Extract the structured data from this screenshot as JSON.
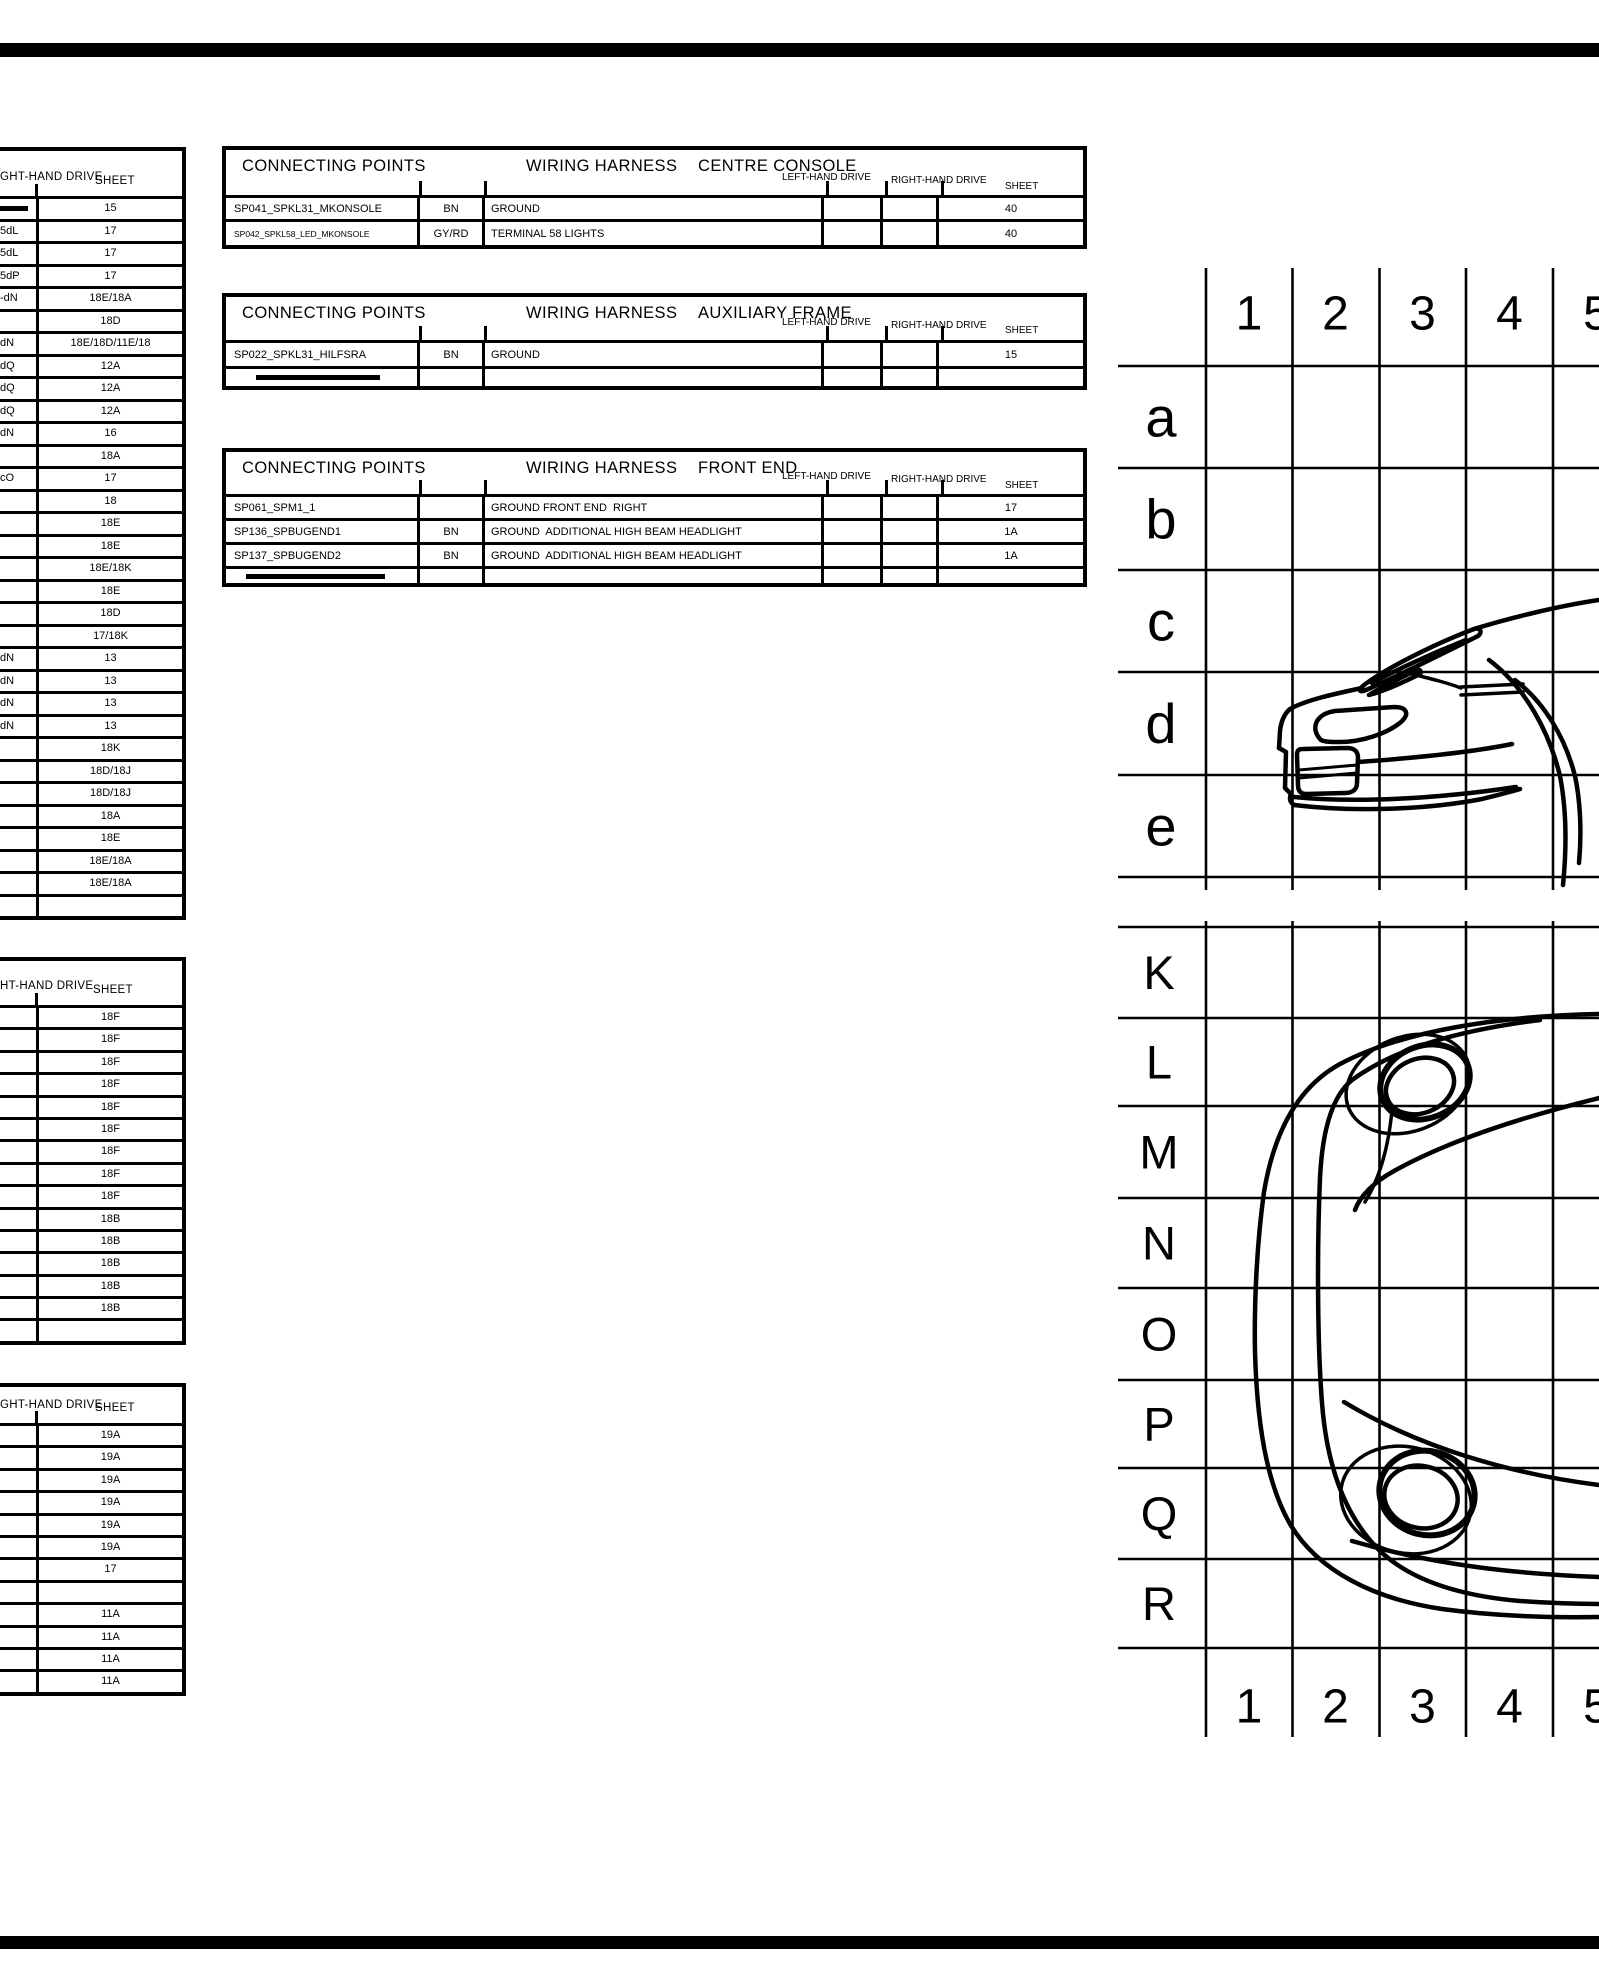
{
  "connecting_tables": [
    {
      "title": "CONNECTING POINTS",
      "harness_label": "WIRING HARNESS",
      "area": "CENTRE CONSOLE",
      "lhd_label": "LEFT-HAND DRIVE",
      "rhd_label": "RIGHT-HAND DRIVE",
      "sheet_label": "SHEET",
      "rows": [
        {
          "name": "SP041_SPKL31_MKONSOLE",
          "color": "BN",
          "desc": "GROUND",
          "lhd": "",
          "rhd": "",
          "sheet": "40",
          "small": false
        },
        {
          "name": "SP042_SPKL58_LED_MKONSOLE",
          "color": "GY/RD",
          "desc": "TERMINAL 58 LIGHTS",
          "lhd": "",
          "rhd": "",
          "sheet": "40",
          "small": true
        }
      ],
      "redacted_row": false
    },
    {
      "title": "CONNECTING POINTS",
      "harness_label": "WIRING HARNESS",
      "area": "AUXILIARY FRAME",
      "lhd_label": "LEFT-HAND DRIVE",
      "rhd_label": "RIGHT-HAND DRIVE",
      "sheet_label": "SHEET",
      "rows": [
        {
          "name": "SP022_SPKL31_HILFSRA",
          "color": "BN",
          "desc": "GROUND",
          "lhd": "",
          "rhd": "",
          "sheet": "15",
          "small": false
        }
      ],
      "redacted_row": true
    },
    {
      "title": "CONNECTING POINTS",
      "harness_label": "WIRING HARNESS",
      "area": "FRONT END",
      "lhd_label": "LEFT-HAND DRIVE",
      "rhd_label": "RIGHT-HAND DRIVE",
      "sheet_label": "SHEET",
      "rows": [
        {
          "name": "SP061_SPM1_1",
          "color": "",
          "desc": "GROUND FRONT END  RIGHT",
          "lhd": "",
          "rhd": "",
          "sheet": "17",
          "small": false
        },
        {
          "name": "SP136_SPBUGEND1",
          "color": "BN",
          "desc": "GROUND  ADDITIONAL HIGH BEAM HEADLIGHT",
          "lhd": "",
          "rhd": "",
          "sheet": "1A",
          "small": false
        },
        {
          "name": "SP137_SPBUGEND2",
          "color": "BN",
          "desc": "GROUND  ADDITIONAL HIGH BEAM HEADLIGHT",
          "lhd": "",
          "rhd": "",
          "sheet": "1A",
          "small": false
        }
      ],
      "redacted_row": true
    }
  ],
  "left_tables": [
    {
      "drive_label": "GHT-HAND DRIVE",
      "sheet_label": "SHEET",
      "rows": [
        {
          "frag": "",
          "sheet": "15",
          "redacted": true
        },
        {
          "frag": "5dL",
          "sheet": "17",
          "redacted": false
        },
        {
          "frag": "5dL",
          "sheet": "17",
          "redacted": false
        },
        {
          "frag": "5dP",
          "sheet": "17",
          "redacted": false
        },
        {
          "frag": "-dN",
          "sheet": "18E/18A",
          "redacted": false
        },
        {
          "frag": "",
          "sheet": "18D",
          "redacted": false
        },
        {
          "frag": "dN",
          "sheet": "18E/18D/11E/18",
          "redacted": false
        },
        {
          "frag": "dQ",
          "sheet": "12A",
          "redacted": false
        },
        {
          "frag": "dQ",
          "sheet": "12A",
          "redacted": false
        },
        {
          "frag": "dQ",
          "sheet": "12A",
          "redacted": false
        },
        {
          "frag": "dN",
          "sheet": "16",
          "redacted": false
        },
        {
          "frag": "",
          "sheet": "18A",
          "redacted": false
        },
        {
          "frag": "cO",
          "sheet": "17",
          "redacted": false
        },
        {
          "frag": "",
          "sheet": "18",
          "redacted": false
        },
        {
          "frag": "",
          "sheet": "18E",
          "redacted": false
        },
        {
          "frag": "",
          "sheet": "18E",
          "redacted": false
        },
        {
          "frag": "",
          "sheet": "18E/18K",
          "redacted": false
        },
        {
          "frag": "",
          "sheet": "18E",
          "redacted": false
        },
        {
          "frag": "",
          "sheet": "18D",
          "redacted": false
        },
        {
          "frag": "",
          "sheet": "17/18K",
          "redacted": false
        },
        {
          "frag": "dN",
          "sheet": "13",
          "redacted": false
        },
        {
          "frag": "dN",
          "sheet": "13",
          "redacted": false
        },
        {
          "frag": "dN",
          "sheet": "13",
          "redacted": false
        },
        {
          "frag": "dN",
          "sheet": "13",
          "redacted": false
        },
        {
          "frag": "",
          "sheet": "18K",
          "redacted": false
        },
        {
          "frag": "",
          "sheet": "18D/18J",
          "redacted": false
        },
        {
          "frag": "",
          "sheet": "18D/18J",
          "redacted": false
        },
        {
          "frag": "",
          "sheet": "18A",
          "redacted": false
        },
        {
          "frag": "",
          "sheet": "18E",
          "redacted": false
        },
        {
          "frag": "",
          "sheet": "18E/18A",
          "redacted": false
        },
        {
          "frag": "",
          "sheet": "18E/18A",
          "redacted": false
        },
        {
          "frag": "",
          "sheet": "",
          "redacted": false
        }
      ]
    },
    {
      "drive_label": "HT-HAND DRIVE",
      "sheet_label": "SHEET",
      "rows": [
        {
          "frag": "",
          "sheet": "18F",
          "redacted": false
        },
        {
          "frag": "",
          "sheet": "18F",
          "redacted": false
        },
        {
          "frag": "",
          "sheet": "18F",
          "redacted": false
        },
        {
          "frag": "",
          "sheet": "18F",
          "redacted": false
        },
        {
          "frag": "",
          "sheet": "18F",
          "redacted": false
        },
        {
          "frag": "",
          "sheet": "18F",
          "redacted": false
        },
        {
          "frag": "",
          "sheet": "18F",
          "redacted": false
        },
        {
          "frag": "",
          "sheet": "18F",
          "redacted": false
        },
        {
          "frag": "",
          "sheet": "18F",
          "redacted": false
        },
        {
          "frag": "",
          "sheet": "18B",
          "redacted": false
        },
        {
          "frag": "",
          "sheet": "18B",
          "redacted": false
        },
        {
          "frag": "",
          "sheet": "18B",
          "redacted": false
        },
        {
          "frag": "",
          "sheet": "18B",
          "redacted": false
        },
        {
          "frag": "",
          "sheet": "18B",
          "redacted": false
        },
        {
          "frag": "",
          "sheet": "",
          "redacted": false
        }
      ]
    },
    {
      "drive_label": "GHT-HAND DRIVE",
      "sheet_label": "SHEET",
      "rows": [
        {
          "frag": "",
          "sheet": "19A",
          "redacted": false
        },
        {
          "frag": "",
          "sheet": "19A",
          "redacted": false
        },
        {
          "frag": "",
          "sheet": "19A",
          "redacted": false
        },
        {
          "frag": "",
          "sheet": "19A",
          "redacted": false
        },
        {
          "frag": "",
          "sheet": "19A",
          "redacted": false
        },
        {
          "frag": "",
          "sheet": "19A",
          "redacted": false
        },
        {
          "frag": "",
          "sheet": "17",
          "redacted": false
        },
        {
          "frag": "",
          "sheet": "",
          "redacted": false
        },
        {
          "frag": "",
          "sheet": "11A",
          "redacted": false
        },
        {
          "frag": "",
          "sheet": "11A",
          "redacted": false
        },
        {
          "frag": "",
          "sheet": "11A",
          "redacted": false
        },
        {
          "frag": "",
          "sheet": "11A",
          "redacted": false
        }
      ]
    }
  ],
  "grid": {
    "column_labels": [
      "1",
      "2",
      "3",
      "4",
      "5"
    ],
    "upper_row_labels": [
      "a",
      "b",
      "c",
      "d",
      "e"
    ],
    "lower_row_labels": [
      "K",
      "L",
      "M",
      "N",
      "O",
      "P",
      "Q",
      "R"
    ]
  }
}
